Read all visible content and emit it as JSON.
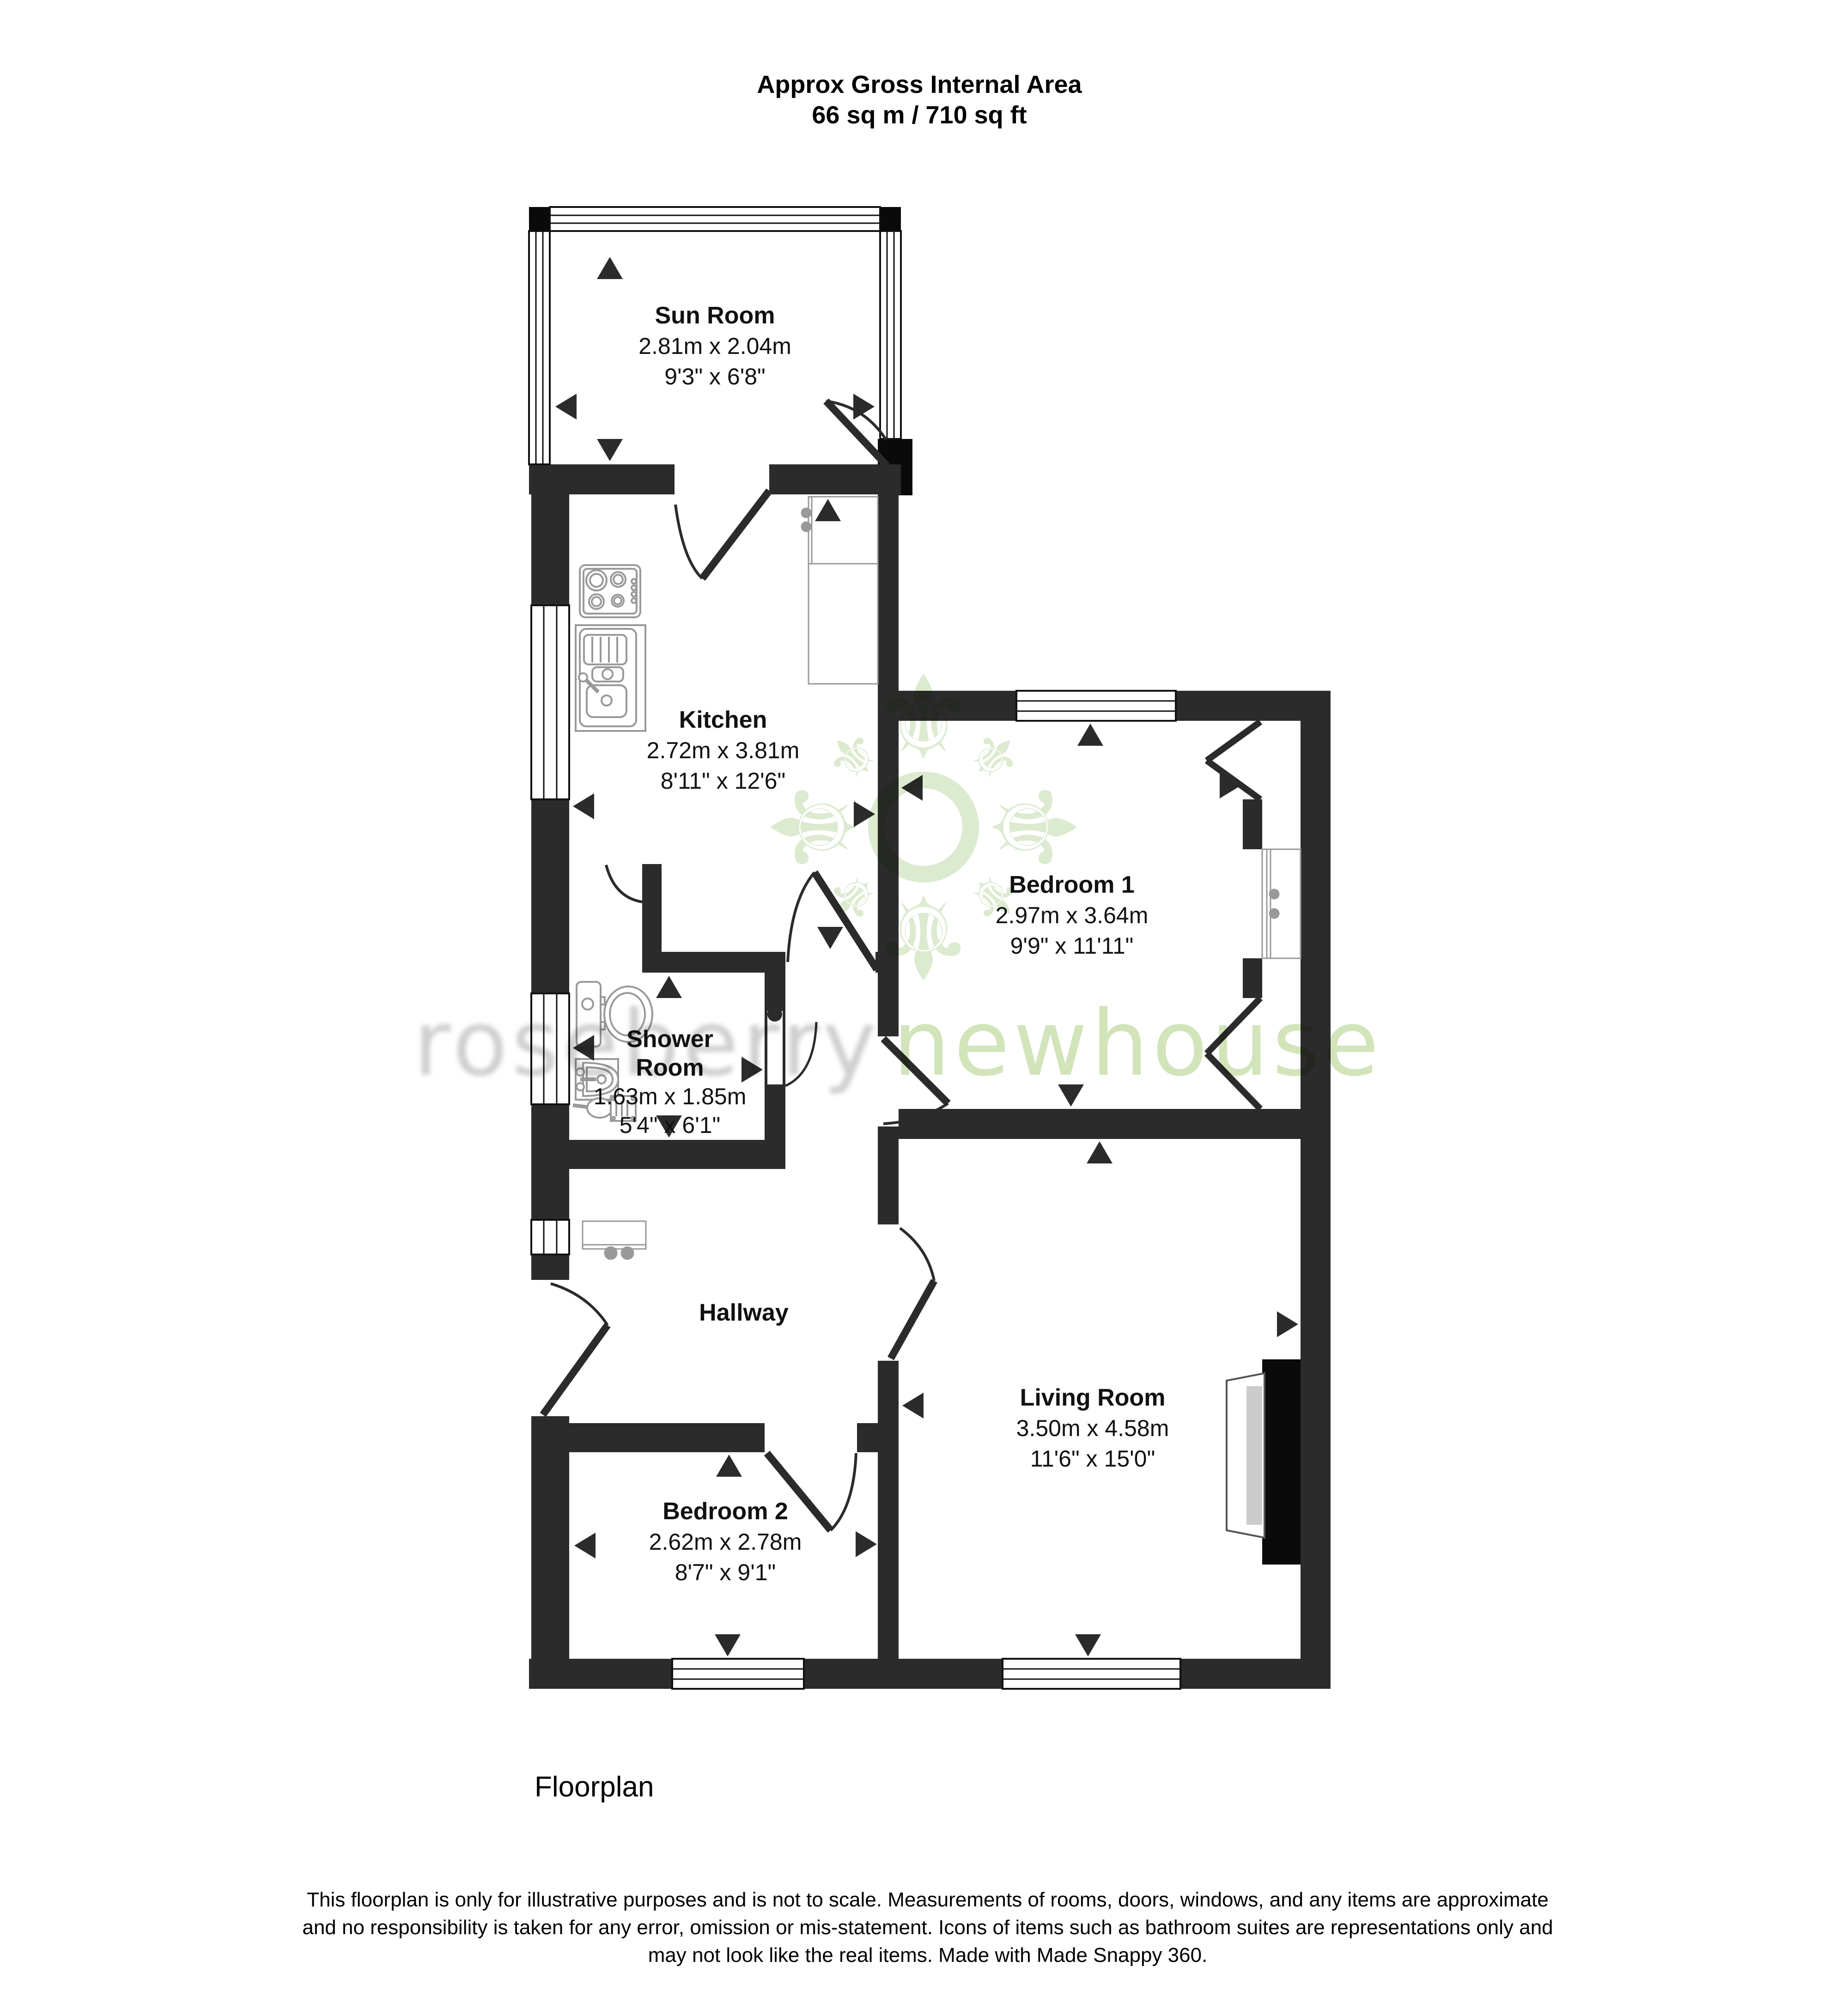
{
  "title": {
    "line1": "Approx Gross Internal Area",
    "line2": "66 sq m / 710 sq ft"
  },
  "rooms": [
    {
      "id": "sun-room",
      "name": "Sun Room",
      "metric": "2.81m x 2.04m",
      "imperial": "9'3\" x 6'8\""
    },
    {
      "id": "kitchen",
      "name": "Kitchen",
      "metric": "2.72m x 3.81m",
      "imperial": "8'11\" x 12'6\""
    },
    {
      "id": "bedroom-1",
      "name": "Bedroom 1",
      "metric": "2.97m x 3.64m",
      "imperial": "9'9\" x 11'11\""
    },
    {
      "id": "shower-room",
      "name_line1": "Shower",
      "name_line2": "Room",
      "metric": "1.63m x 1.85m",
      "imperial": "5'4\" x 6'1\""
    },
    {
      "id": "hallway",
      "name": "Hallway"
    },
    {
      "id": "living-room",
      "name": "Living Room",
      "metric": "3.50m x 4.58m",
      "imperial": "11'6\" x 15'0\""
    },
    {
      "id": "bedroom-2",
      "name": "Bedroom 2",
      "metric": "2.62m x 2.78m",
      "imperial": "8'7\" x 9'1\""
    }
  ],
  "watermark": {
    "word1": "roseberry",
    "word2": "newhouse",
    "logo_icon": "fleur-de-lis-emblem",
    "word1_color": "#c7c7c7",
    "word2_color": "#cfe2b4",
    "logo_color": "#dcead0"
  },
  "colors": {
    "wall": "#2b2b2b",
    "fixture_outline": "#999999",
    "label_text": "#111111"
  },
  "footer": {
    "caption": "Floorplan",
    "disclaimer_line1": "This floorplan is only for illustrative purposes and is not to scale. Measurements of rooms, doors, windows, and any items are approximate",
    "disclaimer_line2": "and no responsibility is taken for any error, omission or mis-statement. Icons of items such as bathroom suites are representations only and",
    "disclaimer_line3": "may not look like the real items. Made with Made Snappy 360."
  }
}
